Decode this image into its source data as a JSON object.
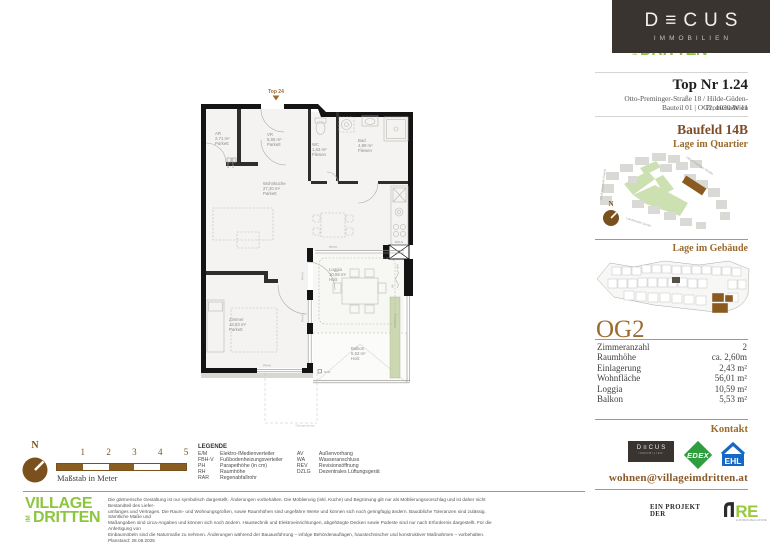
{
  "colors": {
    "accent_brown": "#9c6b2e",
    "dark_brown": "#7d4b26",
    "line_brown": "#b2956a",
    "village_green": "#8cc63e",
    "edex_green": "#2f9e41",
    "ehl_blue": "#1668c5",
    "are_green": "#98ca3c",
    "dark_box": "#393430",
    "highlight_brown": "#8a5a20",
    "planter_green": "#ccd8b2"
  },
  "brand": {
    "decus_wordmark": "D≡CUS",
    "decus_sub": "IMMOBILIEN",
    "village_line1": "VILLAGE",
    "village_im": "IM",
    "village_line2": "DRITTEN"
  },
  "header": {
    "top_nr": "Top Nr 1.24",
    "address_line1": "Otto-Preminger-Straße 18 / Hilde-Güden-Promenade 11",
    "address_line2": "Bauteil 01 | OG2, 1030 Wien",
    "baufeld": "Baufeld 14B",
    "quartier_heading": "Lage im Quartier",
    "gebaeude_heading": "Lage im Gebäude",
    "floor_label": "OG2"
  },
  "site_plan": {
    "compass": "N",
    "streets": [
      "Otto-Preminger-Straße",
      "Adolf-Blamauer-Gasse",
      "Landstraßer Gürtel"
    ]
  },
  "details": {
    "rows": [
      {
        "label": "Zimmeranzahl",
        "value": "2"
      },
      {
        "label": "Raumhöhe",
        "value": "ca. 2,60m"
      },
      {
        "label": "Einlagerung",
        "value": "2,43 m²"
      },
      {
        "label": "Wohnfläche",
        "value": "56,01 m²"
      },
      {
        "label": "Loggia",
        "value": "10,59 m²"
      },
      {
        "label": "Balkon",
        "value": "5,53 m²"
      }
    ]
  },
  "contact": {
    "heading": "Kontakt",
    "email": "wohnen@villageimdritten.at",
    "edex": "EDEX",
    "ehl": "EHL"
  },
  "project": {
    "prefix": "EIN PROJEKT DER",
    "are_text": "RE",
    "are_sub": "AUSTRIAN REAL ESTATE"
  },
  "scalebar": {
    "compass": "N",
    "label": "Maßstab in Meter",
    "ticks": [
      "1",
      "2",
      "3",
      "4",
      "5"
    ]
  },
  "legend": {
    "title": "LEGENDE",
    "col1": [
      {
        "abbr": "E/M",
        "desc": "Elektro-/Medienverteiler"
      },
      {
        "abbr": "FBH-V",
        "desc": "Fußbodenheizungsverteiler"
      },
      {
        "abbr": "PH",
        "desc": "Parapethöhe (in cm)"
      },
      {
        "abbr": "RH",
        "desc": "Raumhöhe"
      },
      {
        "abbr": "RAR",
        "desc": "Regenabfallrohr"
      }
    ],
    "col2": [
      {
        "abbr": "AV",
        "desc": "Außenvorhang"
      },
      {
        "abbr": "WA",
        "desc": "Wasseranschluss"
      },
      {
        "abbr": "REV",
        "desc": "Revisionsöffnung"
      },
      {
        "abbr": "DZLG",
        "desc": "Dezentrales Lüftungsgerät"
      }
    ]
  },
  "disclaimer": {
    "line1": "Die gärtnerische Gestaltung ist nur symbolisch dargestellt. Änderungen vorbehalten. Die Möblierung (inkl. Küche) und Begrünung gilt nur als Möblierungsvorschlag und ist daher nicht Bestandteil des Liefer-",
    "line2": "umfanges und Vertrages. Die Raum- und Wohnungsgrößen, sowie Raumhöhen sind ungefähre Werte und können sich noch geringfügig ändern. Bauübliche Toleranzen sind zulässig. Sämtliche Maße und",
    "line3": "Maßangaben sind circa-Angaben und können sich noch ändern. Haustechnik und Elektroeinrichtungen, abgehängte Decken sowie Podeste sind nur nach Erfordernis dargestellt. Für die Anfertigung von",
    "line4": "Einbaumöbeln sind die Naturmaße zu nehmen. Änderungen während der Bauausführung – infolge Behördenauflagen, haustechnischer und konstruktiver Maßnahmen – vorbehalten. Planstand: 28.08.2025"
  },
  "floorplan": {
    "top_label": "Top 24",
    "rooms": [
      {
        "name": "AR",
        "area": "2,71 m²",
        "floor": "Parkett"
      },
      {
        "name": "VR",
        "area": "5,65 m²",
        "floor": "Parkett"
      },
      {
        "name": "WC",
        "area": "1,63 m²",
        "floor": "Fliesen"
      },
      {
        "name": "Bad",
        "area": "4,99 m²",
        "floor": "Fliesen"
      },
      {
        "name": "Wohnküche",
        "area": "27,20 m²",
        "floor": "Parkett"
      },
      {
        "name": "Zimmer",
        "area": "13,83 m²",
        "floor": "Parkett"
      },
      {
        "name": "Loggia",
        "area": "10,59 m²",
        "floor": "Holz"
      },
      {
        "name": "Balkon",
        "area": "5,53 m²",
        "floor": "Holz"
      }
    ],
    "annotations": {
      "ph": "PH=0",
      "em": "E/M",
      "fbhv": "FBH-V",
      "dzlg": "DZLG",
      "wa": "WA",
      "av": "AV",
      "rar": "RAR",
      "pflanztrog": "Pflanztrog",
      "obergeschoss": "Obergeschoss"
    }
  }
}
